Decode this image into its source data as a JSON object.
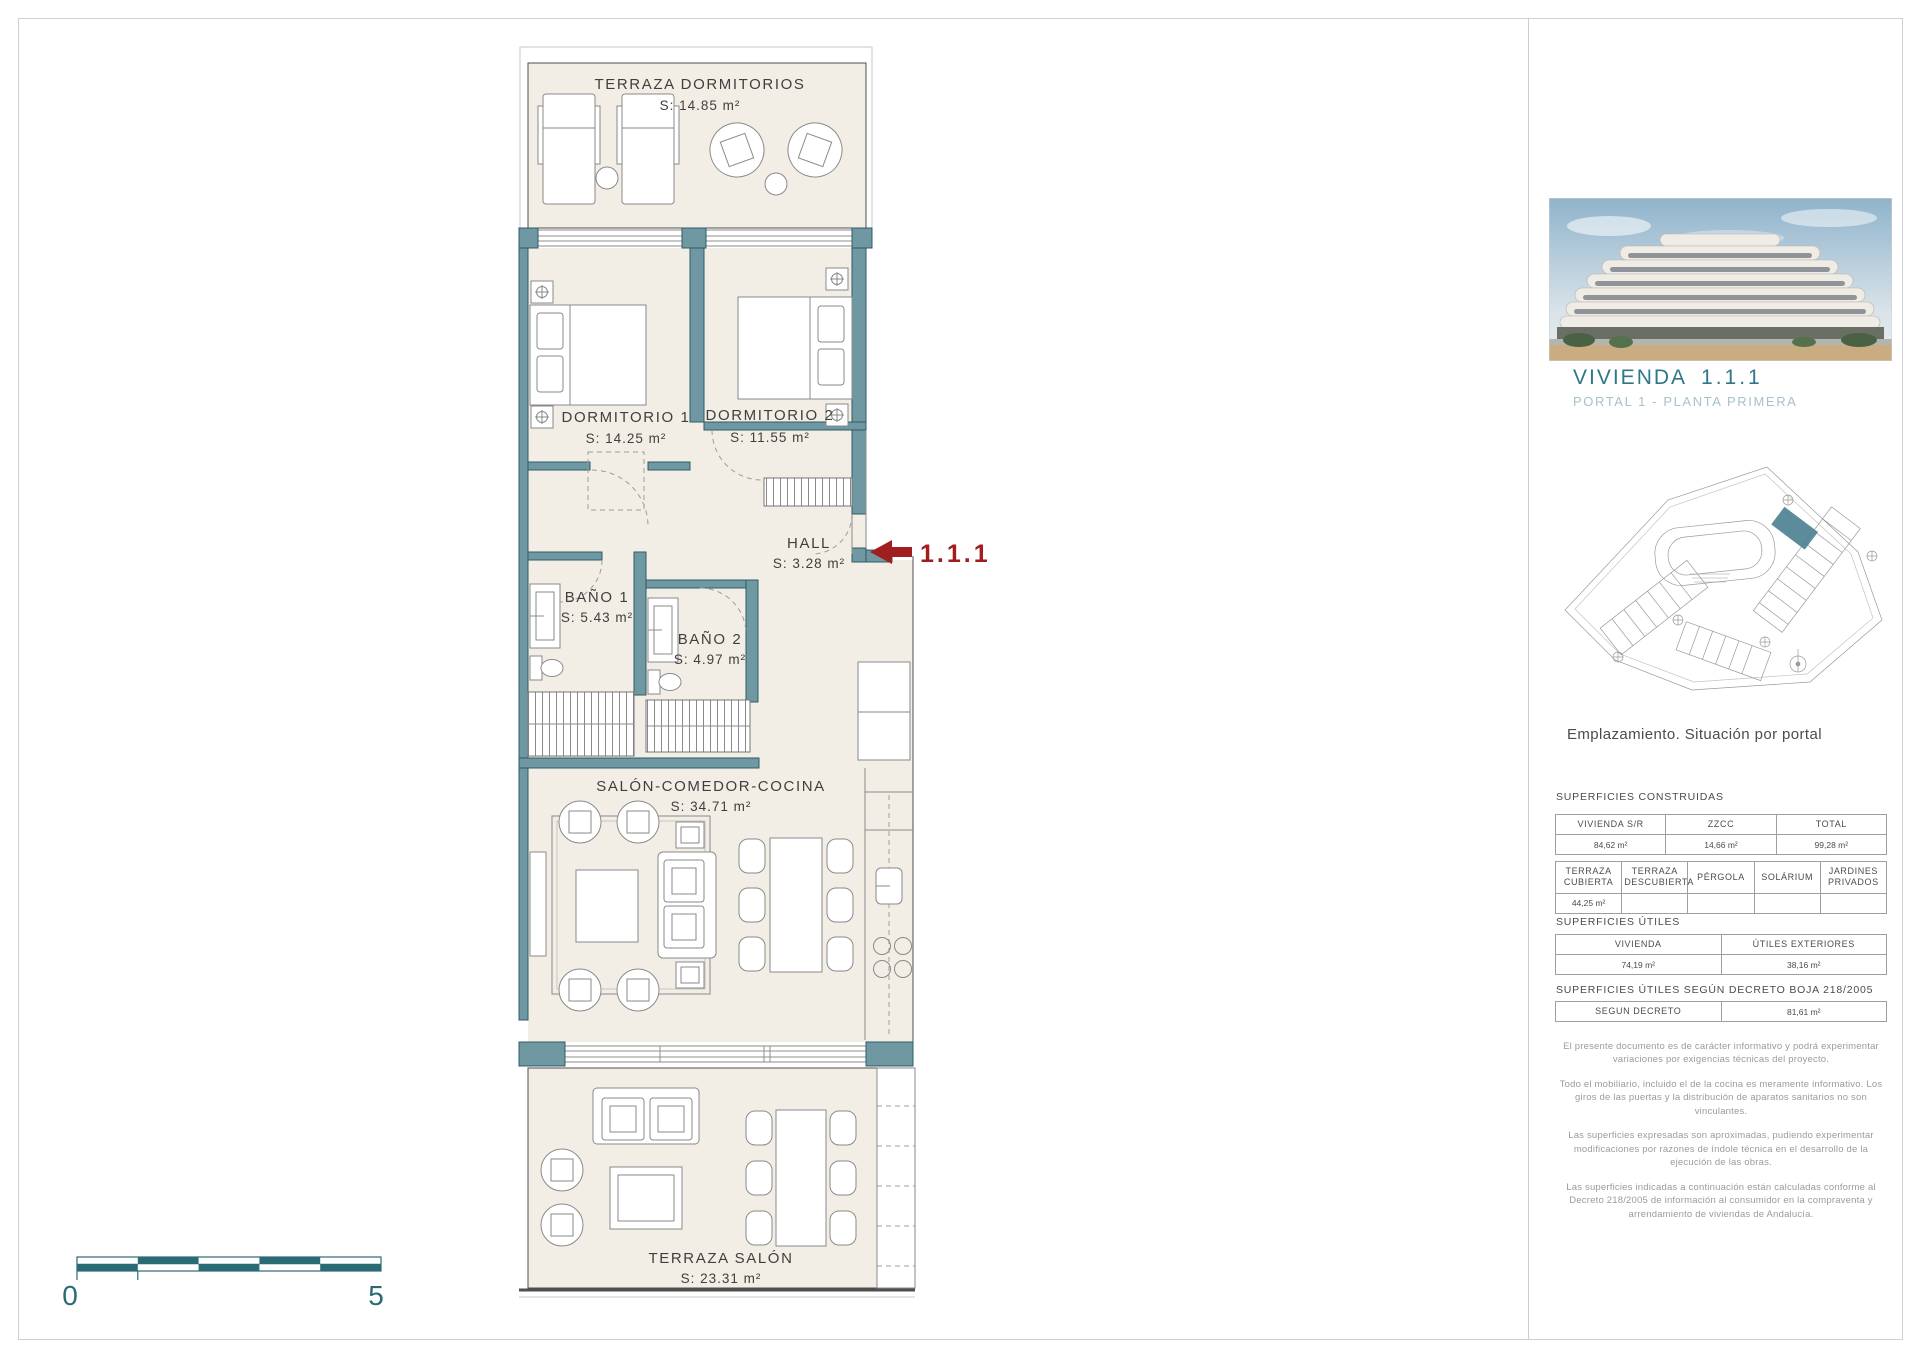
{
  "plan": {
    "rooms": [
      {
        "name": "TERRAZA DORMITORIOS",
        "area": "S: 14.85 m²"
      },
      {
        "name": "DORMITORIO 1",
        "area": "S: 14.25 m²"
      },
      {
        "name": "DORMITORIO 2",
        "area": "S: 11.55 m²"
      },
      {
        "name": "HALL",
        "area": "S: 3.28 m²"
      },
      {
        "name": "BAÑO 1",
        "area": "S: 5.43 m²"
      },
      {
        "name": "BAÑO 2",
        "area": "S: 4.97 m²"
      },
      {
        "name": "SALÓN-COMEDOR-COCINA",
        "area": "S: 34.71 m²"
      },
      {
        "name": "TERRAZA SALÓN",
        "area": "S: 23.31 m²"
      }
    ],
    "unit_marker": "1.1.1",
    "scale": {
      "min": "0",
      "max": "5"
    }
  },
  "sidebar": {
    "unit_title": "VIVIENDA",
    "unit_number": "1.1.1",
    "subtitle": "PORTAL 1 - PLANTA PRIMERA",
    "site_caption": "Emplazamiento. Situación por portal",
    "sections": {
      "construidas_label": "SUPERFICIES CONSTRUIDAS",
      "utiles_label": "SUPERFICIES ÚTILES",
      "decreto_label": "SUPERFICIES ÚTILES SEGÚN DECRETO BOJA 218/2005"
    },
    "table_construidas": {
      "headers": [
        "VIVIENDA S/R",
        "ZZCC",
        "TOTAL"
      ],
      "values": [
        "84,62 m²",
        "14,66 m²",
        "99,28 m²"
      ]
    },
    "table_exteriores": {
      "headers": [
        "TERRAZA CUBIERTA",
        "TERRAZA DESCUBIERTA",
        "PÉRGOLA",
        "SOLÁRIUM",
        "JARDINES PRIVADOS"
      ],
      "values": [
        "44,25 m²",
        "",
        "",
        "",
        ""
      ]
    },
    "table_utiles": {
      "headers": [
        "VIVIENDA",
        "ÚTILES EXTERIORES"
      ],
      "values": [
        "74,19 m²",
        "38,16 m²"
      ]
    },
    "table_decreto": {
      "header": "SEGUN DECRETO",
      "value": "81,61 m²"
    },
    "disclaimers": [
      "El presente documento es de carácter informativo y podrá experimentar variaciones por exigencias técnicas del  proyecto.",
      "Todo el mobiliario, incluido el de la cocina es meramente informativo. Los giros de las puertas y la distribución de aparatos sanitarios no son vinculantes.",
      "Las superficies expresadas son aproximadas, pudiendo experimentar modificaciones por razones de índole técnica en el desarrollo de la ejecución de las obras.",
      "Las superficies indicadas a continuación están calculadas conforme al Decreto 218/2005 de información al consumidor en la compraventa  y arrendamiento de viviendas de Andalucía."
    ]
  },
  "colors": {
    "wall_teal": "#6f98a2",
    "scale_teal": "#2a6a74",
    "title_teal": "#2e7787",
    "accent_red": "#a01d20",
    "floor_cream": "#f3eee5"
  }
}
